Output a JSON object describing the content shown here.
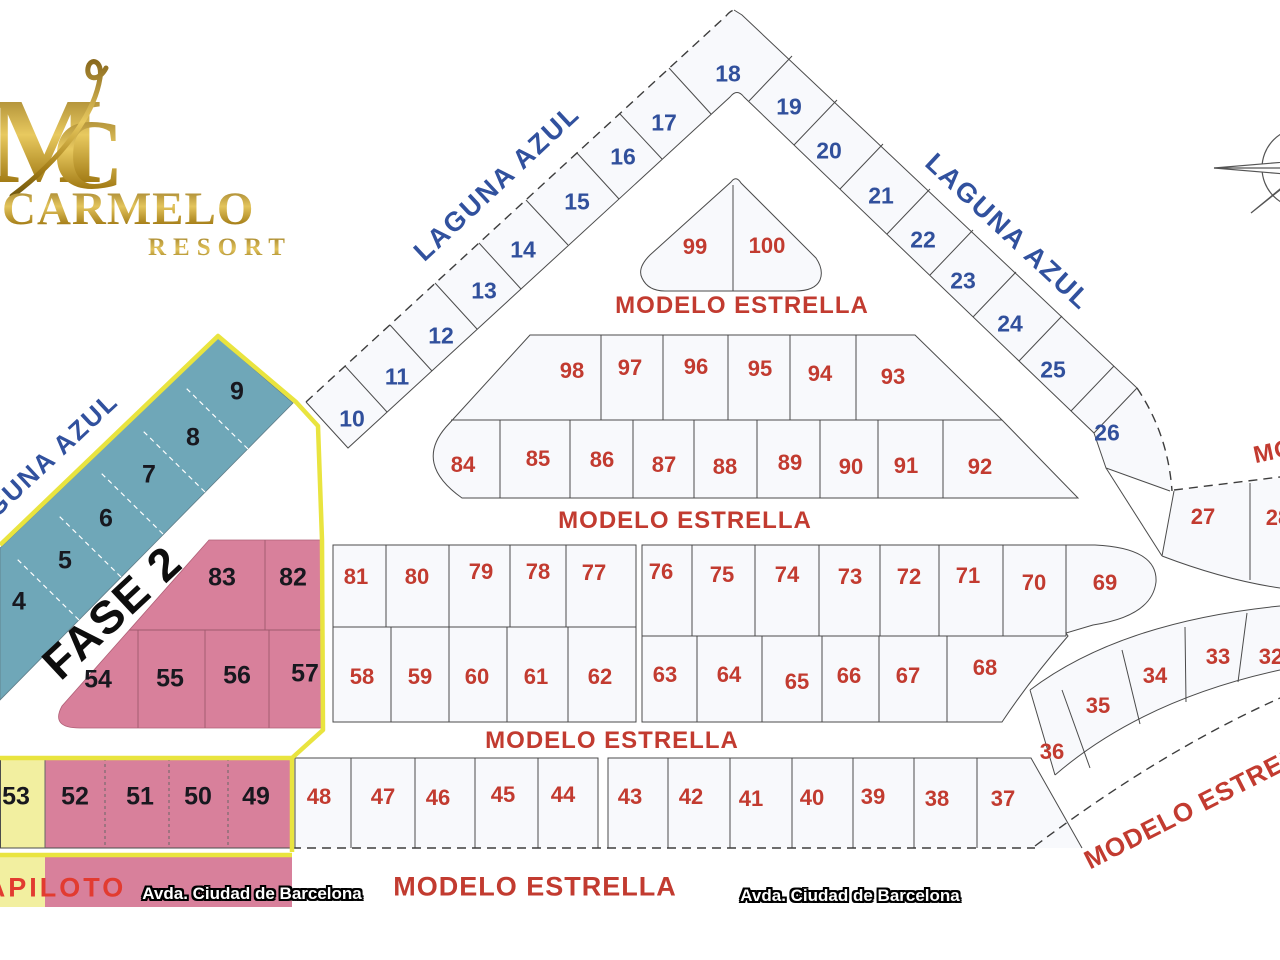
{
  "logo": {
    "monogram_m": "M",
    "monogram_c": "C",
    "title": "CARMELO",
    "subtitle": "RESORT"
  },
  "colors": {
    "fase2_teal": "#6fa7b8",
    "fase2_pink": "#d8809b",
    "fase2_yellow_lot": "#f2efa0",
    "boundary_yellow": "#e9e43f",
    "lot_number_blue": "#31509c",
    "lot_number_red": "#c23b30",
    "lot_number_dark": "#18181f",
    "street_blue": "#31519e",
    "street_red": "#c23b30",
    "logo_gold": "#c9a23a",
    "lot_fill": "#f8f9fc",
    "line_gray": "#4b4b4b"
  },
  "street_labels": [
    {
      "id": "street-laguna-azul-nw",
      "t": "LAGUNA AZUL",
      "x": 497,
      "y": 183,
      "r": -43,
      "s": 27,
      "st": "laguna"
    },
    {
      "id": "street-laguna-azul-ne",
      "t": "LAGUNA AZUL",
      "x": 1008,
      "y": 232,
      "r": 43,
      "s": 27,
      "st": "laguna"
    },
    {
      "id": "street-laguna-azul-west",
      "t": "LAGUNA AZUL",
      "x": 38,
      "y": 468,
      "r": -43,
      "s": 26,
      "st": "laguna"
    },
    {
      "id": "street-modelo-estrella-1",
      "t": "MODELO ESTRELLA",
      "x": 742,
      "y": 306,
      "r": 0,
      "s": 24,
      "st": "modelo"
    },
    {
      "id": "street-modelo-estrella-2",
      "t": "MODELO ESTRELLA",
      "x": 685,
      "y": 521,
      "r": 0,
      "s": 24,
      "st": "modelo"
    },
    {
      "id": "street-modelo-estrella-3",
      "t": "MODELO ESTRELLA",
      "x": 612,
      "y": 741,
      "r": 0,
      "s": 24,
      "st": "modelo"
    },
    {
      "id": "street-modelo-estrella-4",
      "t": "MODELO ESTRELLA",
      "x": 535,
      "y": 887,
      "r": 0,
      "s": 27,
      "st": "modelo"
    },
    {
      "id": "street-modelo-estrella-curve",
      "t": "MODELO ESTRELLA",
      "x": 1208,
      "y": 800,
      "r": -27,
      "s": 26,
      "st": "modelo"
    },
    {
      "id": "street-modelo-estrella-right",
      "t": "MODELO ESTRELLA",
      "x": 1378,
      "y": 430,
      "r": -12,
      "s": 24,
      "st": "modelo"
    },
    {
      "id": "avda-ciudad-barcelona-left",
      "t": "Avda. Ciudad de Barcelona",
      "x": 252,
      "y": 894,
      "r": 0,
      "s": 17,
      "st": "avda"
    },
    {
      "id": "avda-ciudad-barcelona-right",
      "t": "Avda. Ciudad de Barcelona",
      "x": 850,
      "y": 896,
      "r": 0,
      "s": 17,
      "st": "avda"
    },
    {
      "id": "fase-2-label",
      "t": "FASE 2",
      "x": 112,
      "y": 612,
      "r": -43,
      "s": 46,
      "st": "fase"
    },
    {
      "id": "piloto-label",
      "t": "APILOTO",
      "x": 56,
      "y": 888,
      "r": 0,
      "s": 27,
      "st": "piloto"
    }
  ],
  "lots": [
    {
      "n": "10",
      "x": 352,
      "y": 419,
      "c": "blue"
    },
    {
      "n": "11",
      "x": 397,
      "y": 377,
      "c": "blue"
    },
    {
      "n": "12",
      "x": 441,
      "y": 336,
      "c": "blue"
    },
    {
      "n": "13",
      "x": 484,
      "y": 291,
      "c": "blue"
    },
    {
      "n": "14",
      "x": 523,
      "y": 250,
      "c": "blue"
    },
    {
      "n": "15",
      "x": 577,
      "y": 202,
      "c": "blue"
    },
    {
      "n": "16",
      "x": 623,
      "y": 157,
      "c": "blue"
    },
    {
      "n": "17",
      "x": 664,
      "y": 123,
      "c": "blue"
    },
    {
      "n": "18",
      "x": 728,
      "y": 74,
      "c": "blue"
    },
    {
      "n": "19",
      "x": 789,
      "y": 107,
      "c": "blue"
    },
    {
      "n": "20",
      "x": 829,
      "y": 151,
      "c": "blue"
    },
    {
      "n": "21",
      "x": 881,
      "y": 196,
      "c": "blue"
    },
    {
      "n": "22",
      "x": 923,
      "y": 240,
      "c": "blue"
    },
    {
      "n": "23",
      "x": 963,
      "y": 281,
      "c": "blue"
    },
    {
      "n": "24",
      "x": 1010,
      "y": 324,
      "c": "blue"
    },
    {
      "n": "25",
      "x": 1053,
      "y": 370,
      "c": "blue"
    },
    {
      "n": "26",
      "x": 1107,
      "y": 433,
      "c": "blue"
    },
    {
      "n": "4",
      "x": 19,
      "y": 602,
      "c": "dark"
    },
    {
      "n": "5",
      "x": 65,
      "y": 561,
      "c": "dark"
    },
    {
      "n": "6",
      "x": 106,
      "y": 519,
      "c": "dark"
    },
    {
      "n": "7",
      "x": 149,
      "y": 475,
      "c": "dark"
    },
    {
      "n": "8",
      "x": 193,
      "y": 438,
      "c": "dark"
    },
    {
      "n": "9",
      "x": 237,
      "y": 392,
      "c": "dark"
    },
    {
      "n": "83",
      "x": 222,
      "y": 578,
      "c": "dark"
    },
    {
      "n": "82",
      "x": 293,
      "y": 578,
      "c": "dark"
    },
    {
      "n": "54",
      "x": 98,
      "y": 680,
      "c": "dark"
    },
    {
      "n": "55",
      "x": 170,
      "y": 679,
      "c": "dark"
    },
    {
      "n": "56",
      "x": 237,
      "y": 676,
      "c": "dark"
    },
    {
      "n": "57",
      "x": 305,
      "y": 674,
      "c": "dark"
    },
    {
      "n": "53",
      "x": 16,
      "y": 797,
      "c": "dark"
    },
    {
      "n": "52",
      "x": 75,
      "y": 797,
      "c": "dark"
    },
    {
      "n": "51",
      "x": 140,
      "y": 797,
      "c": "dark"
    },
    {
      "n": "50",
      "x": 198,
      "y": 797,
      "c": "dark"
    },
    {
      "n": "49",
      "x": 256,
      "y": 797,
      "c": "dark"
    },
    {
      "n": "99",
      "x": 695,
      "y": 247,
      "c": "red"
    },
    {
      "n": "100",
      "x": 767,
      "y": 246,
      "c": "red"
    },
    {
      "n": "98",
      "x": 572,
      "y": 371,
      "c": "red"
    },
    {
      "n": "97",
      "x": 630,
      "y": 368,
      "c": "red"
    },
    {
      "n": "96",
      "x": 696,
      "y": 367,
      "c": "red"
    },
    {
      "n": "95",
      "x": 760,
      "y": 369,
      "c": "red"
    },
    {
      "n": "94",
      "x": 820,
      "y": 374,
      "c": "red"
    },
    {
      "n": "93",
      "x": 893,
      "y": 377,
      "c": "red"
    },
    {
      "n": "84",
      "x": 463,
      "y": 465,
      "c": "red"
    },
    {
      "n": "85",
      "x": 538,
      "y": 459,
      "c": "red"
    },
    {
      "n": "86",
      "x": 602,
      "y": 460,
      "c": "red"
    },
    {
      "n": "87",
      "x": 664,
      "y": 465,
      "c": "red"
    },
    {
      "n": "88",
      "x": 725,
      "y": 467,
      "c": "red"
    },
    {
      "n": "89",
      "x": 790,
      "y": 463,
      "c": "red"
    },
    {
      "n": "90",
      "x": 851,
      "y": 467,
      "c": "red"
    },
    {
      "n": "91",
      "x": 906,
      "y": 466,
      "c": "red"
    },
    {
      "n": "92",
      "x": 980,
      "y": 467,
      "c": "red"
    },
    {
      "n": "81",
      "x": 356,
      "y": 577,
      "c": "red"
    },
    {
      "n": "80",
      "x": 417,
      "y": 577,
      "c": "red"
    },
    {
      "n": "79",
      "x": 481,
      "y": 572,
      "c": "red"
    },
    {
      "n": "78",
      "x": 538,
      "y": 572,
      "c": "red"
    },
    {
      "n": "77",
      "x": 594,
      "y": 573,
      "c": "red"
    },
    {
      "n": "76",
      "x": 661,
      "y": 572,
      "c": "red"
    },
    {
      "n": "75",
      "x": 722,
      "y": 575,
      "c": "red"
    },
    {
      "n": "74",
      "x": 787,
      "y": 575,
      "c": "red"
    },
    {
      "n": "73",
      "x": 850,
      "y": 577,
      "c": "red"
    },
    {
      "n": "72",
      "x": 909,
      "y": 577,
      "c": "red"
    },
    {
      "n": "71",
      "x": 968,
      "y": 576,
      "c": "red"
    },
    {
      "n": "70",
      "x": 1034,
      "y": 583,
      "c": "red"
    },
    {
      "n": "69",
      "x": 1105,
      "y": 583,
      "c": "red"
    },
    {
      "n": "58",
      "x": 362,
      "y": 677,
      "c": "red"
    },
    {
      "n": "59",
      "x": 420,
      "y": 677,
      "c": "red"
    },
    {
      "n": "60",
      "x": 477,
      "y": 677,
      "c": "red"
    },
    {
      "n": "61",
      "x": 536,
      "y": 677,
      "c": "red"
    },
    {
      "n": "62",
      "x": 600,
      "y": 677,
      "c": "red"
    },
    {
      "n": "63",
      "x": 665,
      "y": 675,
      "c": "red"
    },
    {
      "n": "64",
      "x": 729,
      "y": 675,
      "c": "red"
    },
    {
      "n": "65",
      "x": 797,
      "y": 682,
      "c": "red"
    },
    {
      "n": "66",
      "x": 849,
      "y": 676,
      "c": "red"
    },
    {
      "n": "67",
      "x": 908,
      "y": 676,
      "c": "red"
    },
    {
      "n": "68",
      "x": 985,
      "y": 668,
      "c": "red"
    },
    {
      "n": "48",
      "x": 319,
      "y": 797,
      "c": "red"
    },
    {
      "n": "47",
      "x": 383,
      "y": 797,
      "c": "red"
    },
    {
      "n": "46",
      "x": 438,
      "y": 798,
      "c": "red"
    },
    {
      "n": "45",
      "x": 503,
      "y": 795,
      "c": "red"
    },
    {
      "n": "44",
      "x": 563,
      "y": 795,
      "c": "red"
    },
    {
      "n": "43",
      "x": 630,
      "y": 797,
      "c": "red"
    },
    {
      "n": "42",
      "x": 691,
      "y": 797,
      "c": "red"
    },
    {
      "n": "41",
      "x": 751,
      "y": 799,
      "c": "red"
    },
    {
      "n": "40",
      "x": 812,
      "y": 798,
      "c": "red"
    },
    {
      "n": "39",
      "x": 873,
      "y": 797,
      "c": "red"
    },
    {
      "n": "38",
      "x": 937,
      "y": 799,
      "c": "red"
    },
    {
      "n": "37",
      "x": 1003,
      "y": 799,
      "c": "red"
    },
    {
      "n": "36",
      "x": 1052,
      "y": 752,
      "c": "red"
    },
    {
      "n": "35",
      "x": 1098,
      "y": 706,
      "c": "red"
    },
    {
      "n": "34",
      "x": 1155,
      "y": 676,
      "c": "red"
    },
    {
      "n": "33",
      "x": 1218,
      "y": 657,
      "c": "red"
    },
    {
      "n": "32",
      "x": 1271,
      "y": 657,
      "c": "red"
    },
    {
      "n": "27",
      "x": 1203,
      "y": 517,
      "c": "red"
    },
    {
      "n": "28",
      "x": 1278,
      "y": 518,
      "c": "red"
    }
  ]
}
